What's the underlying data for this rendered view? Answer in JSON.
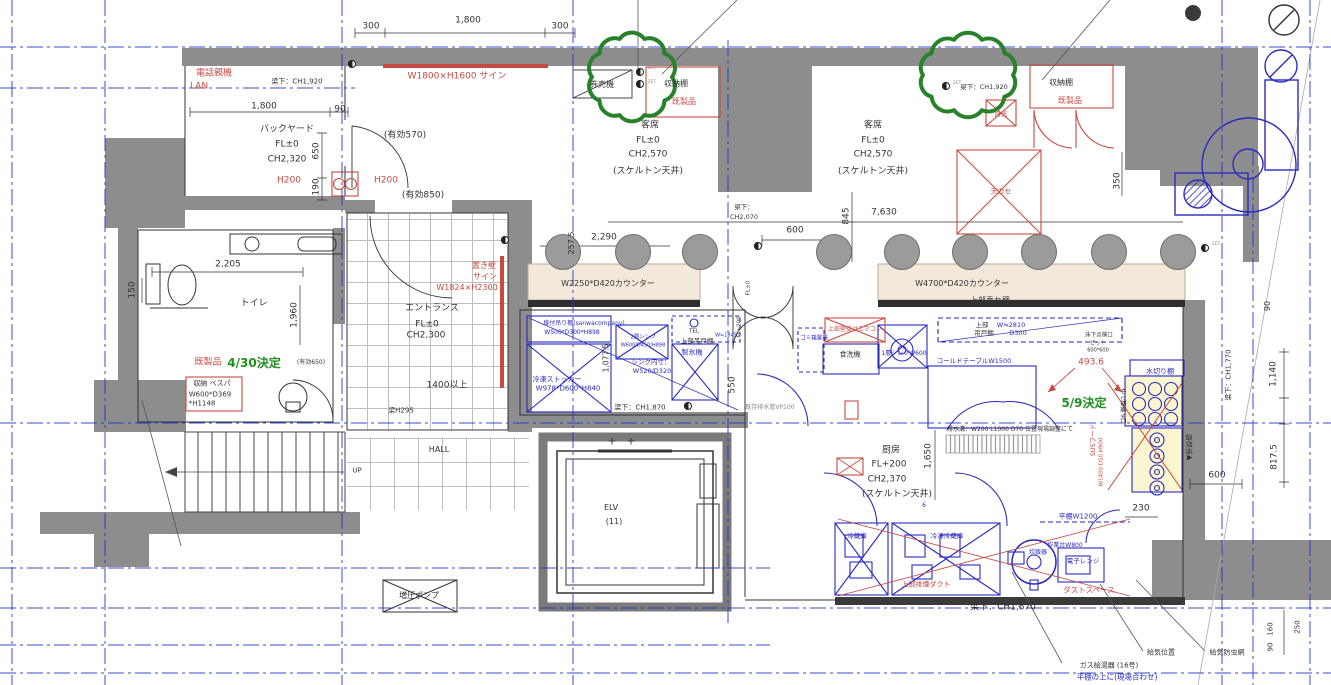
{
  "title": "tenant-fitout-floor-plan",
  "colors": {
    "ink": "#333333",
    "red": "#c64a42",
    "blue": "#2b2bbf",
    "green": "#1f8f1f",
    "gray": "#8a8a8a",
    "wall": "#8d8d8d",
    "grid": "#2438c8",
    "counter": "#f3e9da",
    "equip_fill": "#fbf6cf",
    "cloud": "#27822a"
  },
  "rooms": [
    {
      "name": "バックヤード",
      "fl": "FL±0",
      "ch": "CH2,320"
    },
    {
      "name": "客席",
      "fl": "FL±0",
      "ch": "CH2,570",
      "ceiling": "(スケルトン天井)"
    },
    {
      "name": "トイレ"
    },
    {
      "name": "エントランス",
      "fl": "FL±0",
      "ch": "CH2,300"
    },
    {
      "name": "厨房",
      "fl": "FL+200",
      "ch": "CH2,370",
      "ceiling": "(スケルトン天井)"
    },
    {
      "name": "HALL"
    },
    {
      "name": "ELV (11)"
    }
  ],
  "stools": {
    "y": 251,
    "xs": [
      562,
      632,
      699,
      833,
      901,
      969,
      1038,
      1108,
      1177
    ]
  },
  "revision_clouds": [
    {
      "x": 632,
      "y": 77,
      "rx": 40,
      "ry": 40,
      "bumps": 10
    },
    {
      "x": 968,
      "y": 75,
      "rx": 45,
      "ry": 37,
      "bumps": 10
    }
  ],
  "labels": [
    {
      "n": "dim-top-300-left",
      "t": "300",
      "x": 371,
      "y": 27
    },
    {
      "n": "dim-top-1800",
      "t": "1,800",
      "x": 468,
      "y": 21
    },
    {
      "n": "dim-top-300-right",
      "t": "300",
      "x": 560,
      "y": 27
    },
    {
      "n": "label-phone-base",
      "t": "電話親機",
      "x": 214,
      "y": 74,
      "c": "red"
    },
    {
      "n": "label-lan",
      "t": "LAN",
      "x": 199,
      "y": 87,
      "c": "red"
    },
    {
      "n": "note-beam-ch1920-left",
      "t": "梁下：CH1,920",
      "x": 297,
      "y": 82,
      "s": 7
    },
    {
      "n": "label-sign-w1800",
      "t": "W1800×H1600 サイン",
      "x": 457,
      "y": 77,
      "c": "red"
    },
    {
      "n": "label-ticket-machine",
      "t": "券売機",
      "x": 602,
      "y": 85,
      "s": 8
    },
    {
      "n": "label-shelf-left",
      "t": "収納棚",
      "x": 676,
      "y": 84,
      "s": 8
    },
    {
      "n": "label-ready-made-left",
      "t": "既製品",
      "x": 684,
      "y": 102,
      "c": "red",
      "s": 8
    },
    {
      "n": "dim-backyard-1800",
      "t": "1,800",
      "x": 264,
      "y": 107
    },
    {
      "n": "dim-backyard-90",
      "t": "90",
      "x": 340,
      "y": 110
    },
    {
      "n": "room-backyard",
      "t": "バックヤード",
      "x": 287,
      "y": 130
    },
    {
      "n": "room-backyard-fl",
      "t": "FL±0",
      "x": 287,
      "y": 145
    },
    {
      "n": "room-backyard-ch",
      "t": "CH2,320",
      "x": 287,
      "y": 160
    },
    {
      "n": "label-h200-a",
      "t": "H200",
      "x": 289,
      "y": 181,
      "c": "red"
    },
    {
      "n": "dim-yuko-570",
      "t": "(有効570)",
      "x": 405,
      "y": 136
    },
    {
      "n": "label-h200-b",
      "t": "H200",
      "x": 386,
      "y": 181,
      "c": "red"
    },
    {
      "n": "dim-yuko-850",
      "t": "(有効850)",
      "x": 423,
      "y": 196
    },
    {
      "n": "dim-650",
      "t": "650",
      "x": 317,
      "y": 151,
      "r": -90
    },
    {
      "n": "dim-190",
      "t": "190",
      "x": 317,
      "y": 187,
      "r": -90
    },
    {
      "n": "room-seating-left",
      "t": "客席",
      "x": 650,
      "y": 126
    },
    {
      "n": "room-seating-left-fl",
      "t": "FL±0",
      "x": 648,
      "y": 141
    },
    {
      "n": "room-seating-left-ch",
      "t": "CH2,570",
      "x": 648,
      "y": 155
    },
    {
      "n": "room-seating-left-ceiling",
      "t": "(スケルトン天井)",
      "x": 648,
      "y": 172
    },
    {
      "n": "room-seating-right",
      "t": "客席",
      "x": 873,
      "y": 126
    },
    {
      "n": "room-seating-right-fl",
      "t": "FL±0",
      "x": 873,
      "y": 141
    },
    {
      "n": "room-seating-right-ch",
      "t": "CH2,570",
      "x": 873,
      "y": 155
    },
    {
      "n": "room-seating-right-ceiling",
      "t": "(スケルトン天井)",
      "x": 873,
      "y": 172
    },
    {
      "n": "label-shelf-right",
      "t": "収納棚",
      "x": 1061,
      "y": 83,
      "s": 8
    },
    {
      "n": "label-ready-made-right",
      "t": "既製品",
      "x": 1070,
      "y": 101,
      "c": "red",
      "s": 8
    },
    {
      "n": "note-beam-ch1920-right",
      "t": "梁下：CH1,920",
      "x": 984,
      "y": 87,
      "s": 6.5
    },
    {
      "n": "label-exhaust",
      "t": "排気",
      "x": 1001,
      "y": 114,
      "c": "red",
      "s": 6.5
    },
    {
      "n": "label-ceiling-cassette",
      "t": "天カセ",
      "x": 1001,
      "y": 192,
      "c": "red",
      "s": 7
    },
    {
      "n": "dim-350",
      "t": "350",
      "x": 1118,
      "y": 181,
      "r": -90
    },
    {
      "n": "dim-7630",
      "t": "7,630",
      "x": 884,
      "y": 213
    },
    {
      "n": "note-beam-mid-1",
      "t": "梁下：",
      "x": 744,
      "y": 207,
      "s": 6.5
    },
    {
      "n": "note-beam-mid-2",
      "t": "CH2,070",
      "x": 744,
      "y": 217,
      "s": 6.5
    },
    {
      "n": "dim-845",
      "t": "845",
      "x": 847,
      "y": 216,
      "r": -90
    },
    {
      "n": "dim-600-door",
      "t": "600",
      "x": 795,
      "y": 231
    },
    {
      "n": "dim-2290",
      "t": "2,290",
      "x": 604,
      "y": 238
    },
    {
      "n": "dim-257-5",
      "t": "257.5",
      "x": 572,
      "y": 243,
      "r": -90,
      "s": 8
    },
    {
      "n": "label-counter-left",
      "t": "W2250*D420カウンター",
      "x": 608,
      "y": 284,
      "s": 8
    },
    {
      "n": "label-counter-right",
      "t": "W4700*D420カウンター",
      "x": 962,
      "y": 284,
      "s": 8
    },
    {
      "n": "label-hanging-wall",
      "t": "上部垂れ壁",
      "x": 990,
      "y": 301,
      "s": 8
    },
    {
      "n": "dim-150",
      "t": "150",
      "x": 133,
      "y": 290,
      "r": -90
    },
    {
      "n": "dim-2205",
      "t": "2,205",
      "x": 228,
      "y": 265
    },
    {
      "n": "room-toilet",
      "t": "トイレ",
      "x": 254,
      "y": 304
    },
    {
      "n": "dim-1960",
      "t": "1,960",
      "x": 295,
      "y": 315,
      "r": -90
    },
    {
      "n": "label-ready-made-toilet",
      "t": "既製品",
      "x": 208,
      "y": 363,
      "c": "red"
    },
    {
      "n": "note-decision-430",
      "t": "4/30決定",
      "x": 254,
      "y": 363,
      "c": "green",
      "s": 12,
      "b": 1
    },
    {
      "n": "dim-yuko-650",
      "t": "(有効650)",
      "x": 311,
      "y": 363,
      "s": 6
    },
    {
      "n": "label-vespa-1",
      "t": "収納 ベスパ",
      "x": 212,
      "y": 384,
      "s": 7
    },
    {
      "n": "label-vespa-2",
      "t": "W600*D369",
      "x": 210,
      "y": 395,
      "s": 7
    },
    {
      "n": "label-vespa-3",
      "t": "*H1148",
      "x": 202,
      "y": 404,
      "s": 7
    },
    {
      "n": "label-okikabe-1",
      "t": "置き壁",
      "x": 484,
      "y": 266,
      "c": "red",
      "s": 8
    },
    {
      "n": "label-okikabe-2",
      "t": "サイン",
      "x": 485,
      "y": 277,
      "c": "red",
      "s": 8
    },
    {
      "n": "label-okikabe-3",
      "t": "W1824×H2300",
      "x": 467,
      "y": 288,
      "c": "red",
      "s": 8
    },
    {
      "n": "room-entrance",
      "t": "エントランス",
      "x": 432,
      "y": 309
    },
    {
      "n": "room-entrance-fl",
      "t": "FL±0",
      "x": 427,
      "y": 325
    },
    {
      "n": "room-entrance-ch",
      "t": "CH2,300",
      "x": 426,
      "y": 336
    },
    {
      "n": "dim-1400-over",
      "t": "1400以上",
      "x": 447,
      "y": 386
    },
    {
      "n": "note-beam-h295",
      "t": "梁H295",
      "x": 401,
      "y": 411,
      "s": 7
    },
    {
      "n": "room-hall",
      "t": "HALL",
      "x": 439,
      "y": 450,
      "s": 8
    },
    {
      "n": "label-up",
      "t": "UP",
      "x": 357,
      "y": 471,
      "s": 7
    },
    {
      "n": "room-elv",
      "t": "ELV",
      "x": 611,
      "y": 508,
      "s": 8
    },
    {
      "n": "room-elv-count",
      "t": "(11)",
      "x": 614,
      "y": 522,
      "s": 8
    },
    {
      "n": "label-booster-pump",
      "t": "増圧ポンプ",
      "x": 419,
      "y": 596,
      "s": 8
    },
    {
      "n": "label-hanging-shelf-1",
      "t": "扉付吊り棚(sanwacompany)",
      "x": 584,
      "y": 324,
      "c": "blue",
      "s": 6
    },
    {
      "n": "label-hanging-shelf-2",
      "t": "W500*D300*H898",
      "x": 572,
      "y": 333,
      "c": "blue",
      "s": 6
    },
    {
      "n": "label-freezer-stocker-1",
      "t": "冷凍ストッカー",
      "x": 557,
      "y": 380,
      "c": "blue",
      "s": 7
    },
    {
      "n": "label-freezer-stocker-2",
      "t": "W978*D600*H840",
      "x": 568,
      "y": 389,
      "c": "blue",
      "s": 7
    },
    {
      "n": "label-2-sink-1",
      "t": "2層シンク",
      "x": 643,
      "y": 338,
      "c": "blue",
      "s": 5.5
    },
    {
      "n": "label-2-sink-2",
      "t": "W600/D450/H898",
      "x": 643,
      "y": 346,
      "c": "blue",
      "s": 5
    },
    {
      "n": "label-sink-inner-1",
      "t": "シンク内寸：",
      "x": 651,
      "y": 362,
      "c": "blue",
      "s": 6.5
    },
    {
      "n": "label-sink-inner-2",
      "t": "W520/D320",
      "x": 652,
      "y": 371,
      "c": "blue",
      "s": 6.5
    },
    {
      "n": "label-upper-cabinet-left",
      "t": "上部吊戸棚",
      "x": 697,
      "y": 341,
      "s": 6.5
    },
    {
      "n": "label-w1845",
      "t": "W≒1845",
      "x": 726,
      "y": 336,
      "c": "blue",
      "s": 5
    },
    {
      "n": "label-ice-maker",
      "t": "製氷機",
      "x": 692,
      "y": 353,
      "c": "blue",
      "s": 7
    },
    {
      "n": "note-beam-ch1870",
      "t": "梁下：CH1,870",
      "x": 640,
      "y": 408,
      "s": 7
    },
    {
      "n": "dim-1077-5",
      "t": "1,077.5",
      "x": 606,
      "y": 358,
      "r": -90,
      "s": 7.5
    },
    {
      "n": "dim-550-left",
      "t": "550",
      "x": 733,
      "y": 385,
      "r": -90
    },
    {
      "n": "label-tel",
      "t": "TEL",
      "x": 694,
      "y": 332,
      "s": 5.5
    },
    {
      "n": "label-fl0-door",
      "t": "FL±0",
      "x": 749,
      "y": 288,
      "r": -90,
      "s": 5.5
    },
    {
      "n": "label-fl200-door",
      "t": "FL+200",
      "x": 740,
      "y": 327,
      "r": -90,
      "s": 5.5
    },
    {
      "n": "note-existing-drain",
      "t": "既存排水管VP100",
      "x": 770,
      "y": 408,
      "s": 6,
      "c": "gray"
    },
    {
      "n": "label-trash-area",
      "t": "ゴミ箱置場",
      "x": 814,
      "y": 339,
      "c": "blue",
      "s": 5.5
    },
    {
      "n": "label-wall-aircon",
      "t": "上部壁掛けエアコン",
      "x": 855,
      "y": 330,
      "c": "red",
      "s": 6
    },
    {
      "n": "label-dishwasher",
      "t": "食洗機",
      "x": 850,
      "y": 355,
      "s": 7
    },
    {
      "n": "label-1-sink",
      "t": "1層シンクW600",
      "x": 904,
      "y": 354,
      "c": "blue",
      "s": 6
    },
    {
      "n": "label-cold-table",
      "t": "コールドテーブルW1500",
      "x": 974,
      "y": 361,
      "c": "blue",
      "s": 6.5
    },
    {
      "n": "label-upper-1",
      "t": "上部",
      "x": 982,
      "y": 325,
      "s": 6.5
    },
    {
      "n": "label-upper-2",
      "t": "吊戸棚",
      "x": 984,
      "y": 333,
      "s": 6.5
    },
    {
      "n": "label-w2810",
      "t": "W≒2810",
      "x": 1011,
      "y": 325,
      "c": "blue",
      "s": 6.5
    },
    {
      "n": "label-d300",
      "t": "D300",
      "x": 1018,
      "y": 333,
      "c": "blue",
      "s": 6.5
    },
    {
      "n": "label-floor-hatch-1",
      "t": "床下点検口",
      "x": 1099,
      "y": 336,
      "s": 5.5
    },
    {
      "n": "label-floor-hatch-2",
      "t": "ピット",
      "x": 1098,
      "y": 344,
      "s": 5.5
    },
    {
      "n": "label-floor-hatch-3",
      "t": "600*600",
      "x": 1098,
      "y": 351,
      "s": 5
    },
    {
      "n": "dim-493-6",
      "t": "493.6",
      "x": 1091,
      "y": 363,
      "c": "red",
      "s": 9
    },
    {
      "n": "label-drain-rack",
      "t": "水切り棚",
      "x": 1160,
      "y": 372,
      "c": "blue",
      "s": 7
    },
    {
      "n": "note-decision-59",
      "t": "5/9決定",
      "x": 1084,
      "y": 403,
      "c": "green",
      "s": 12,
      "b": 1
    },
    {
      "n": "label-noodle-boiler",
      "t": "ゆで麺機 9口",
      "x": 1122,
      "y": 406,
      "r": 90,
      "s": 6
    },
    {
      "n": "label-sus-hood-1",
      "t": "SUSフード",
      "x": 1093,
      "y": 440,
      "c": "red",
      "r": -90,
      "s": 6.5
    },
    {
      "n": "label-sus-hood-2",
      "t": "W1400 D50 H900",
      "x": 1102,
      "y": 462,
      "c": "red",
      "r": -90,
      "s": 5.5
    },
    {
      "n": "label-new-wall",
      "t": "▼新設壁",
      "x": 1190,
      "y": 447,
      "r": -90,
      "s": 7
    },
    {
      "n": "dim-600-right",
      "t": "600",
      "x": 1217,
      "y": 476
    },
    {
      "n": "dim-230",
      "t": "230",
      "x": 1141,
      "y": 509
    },
    {
      "n": "note-beam-ch1770",
      "t": "梁下：CH1,770",
      "x": 1229,
      "y": 375,
      "r": -90,
      "s": 7
    },
    {
      "n": "dim-1140",
      "t": "1,140",
      "x": 1274,
      "y": 374,
      "r": -90
    },
    {
      "n": "dim-817-5",
      "t": "817.5",
      "x": 1275,
      "y": 457,
      "r": -90
    },
    {
      "n": "dim-90-right",
      "t": "90",
      "x": 1268,
      "y": 306,
      "r": -90,
      "s": 8
    },
    {
      "n": "room-kitchen",
      "t": "厨房",
      "x": 891,
      "y": 451
    },
    {
      "n": "room-kitchen-fl",
      "t": "FL+200",
      "x": 889,
      "y": 465
    },
    {
      "n": "room-kitchen-ch",
      "t": "CH2,370",
      "x": 887,
      "y": 480
    },
    {
      "n": "room-kitchen-ceiling",
      "t": "(スケルトン天井)",
      "x": 897,
      "y": 495
    },
    {
      "n": "label-six",
      "t": "6",
      "x": 924,
      "y": 506,
      "c": "blue",
      "s": 6
    },
    {
      "n": "dim-1650",
      "t": "1,650",
      "x": 929,
      "y": 456,
      "r": -90
    },
    {
      "n": "note-drain-ditch",
      "t": "排水溝：W200 L1000 D70 位置現場調整にて",
      "x": 1010,
      "y": 430,
      "s": 6
    },
    {
      "n": "label-fridge",
      "t": "冷蔵庫",
      "x": 857,
      "y": 536,
      "c": "blue",
      "s": 6.5
    },
    {
      "n": "label-freezer-fridge",
      "t": "冷凍冷蔵庫",
      "x": 947,
      "y": 536,
      "c": "blue",
      "s": 6.5
    },
    {
      "n": "label-smoke-duct",
      "t": "上部排煙ダクト",
      "x": 926,
      "y": 585,
      "c": "red",
      "s": 7
    },
    {
      "n": "label-rice-cooker",
      "t": "炊飯器",
      "x": 1038,
      "y": 553,
      "c": "blue",
      "s": 6
    },
    {
      "n": "label-work-table",
      "t": "作業台W800",
      "x": 1065,
      "y": 546,
      "c": "blue",
      "s": 6
    },
    {
      "n": "label-microwave",
      "t": "電子レンジ",
      "x": 1083,
      "y": 561,
      "c": "blue",
      "s": 6.5
    },
    {
      "n": "label-flat-shelf",
      "t": "平棚W1200",
      "x": 1078,
      "y": 517,
      "c": "blue",
      "s": 7
    },
    {
      "n": "label-dust-space",
      "t": "ダストスペース",
      "x": 1089,
      "y": 590,
      "c": "red",
      "s": 7.5
    },
    {
      "n": "note-beam-ch1670",
      "t": "梁下：CH1,670",
      "x": 1003,
      "y": 608
    },
    {
      "n": "note-air-supply-pos",
      "t": "給気位置",
      "x": 1161,
      "y": 653,
      "s": 7
    },
    {
      "n": "note-air-supply-screen",
      "t": "給気防虫網",
      "x": 1227,
      "y": 653,
      "s": 7
    },
    {
      "n": "note-gas-heater",
      "t": "ガス給湯器 (16号)",
      "x": 1109,
      "y": 666,
      "s": 7
    },
    {
      "n": "note-on-flat-shelf",
      "t": "平棚の上に(現場合わせ)",
      "x": 1117,
      "y": 677,
      "c": "blue",
      "s": 7.5
    },
    {
      "n": "dim-90-bottom",
      "t": "90",
      "x": 1271,
      "y": 647,
      "r": -90,
      "s": 7
    },
    {
      "n": "dim-160",
      "t": "160",
      "x": 1271,
      "y": 629,
      "r": -90,
      "s": 7
    },
    {
      "n": "dim-250",
      "t": "250",
      "x": 1298,
      "y": 627,
      "r": -90,
      "s": 7
    },
    {
      "n": "mark-plus-1",
      "t": "+",
      "x": 612,
      "y": 441,
      "s": 11
    },
    {
      "n": "mark-plus-2",
      "t": "+",
      "x": 631,
      "y": 441,
      "s": 11
    },
    {
      "n": "label-2et-a",
      "t": "2ET",
      "x": 652,
      "y": 69,
      "s": 4.5,
      "c": "gray"
    },
    {
      "n": "label-2et-b",
      "t": "2ET",
      "x": 652,
      "y": 83,
      "s": 4.5,
      "c": "gray"
    },
    {
      "n": "label-2et-c",
      "t": "2ET",
      "x": 957,
      "y": 84,
      "s": 4.5,
      "c": "gray"
    },
    {
      "n": "label-2et-d",
      "t": "2ET",
      "x": 1216,
      "y": 245,
      "s": 4.5,
      "c": "gray"
    }
  ]
}
